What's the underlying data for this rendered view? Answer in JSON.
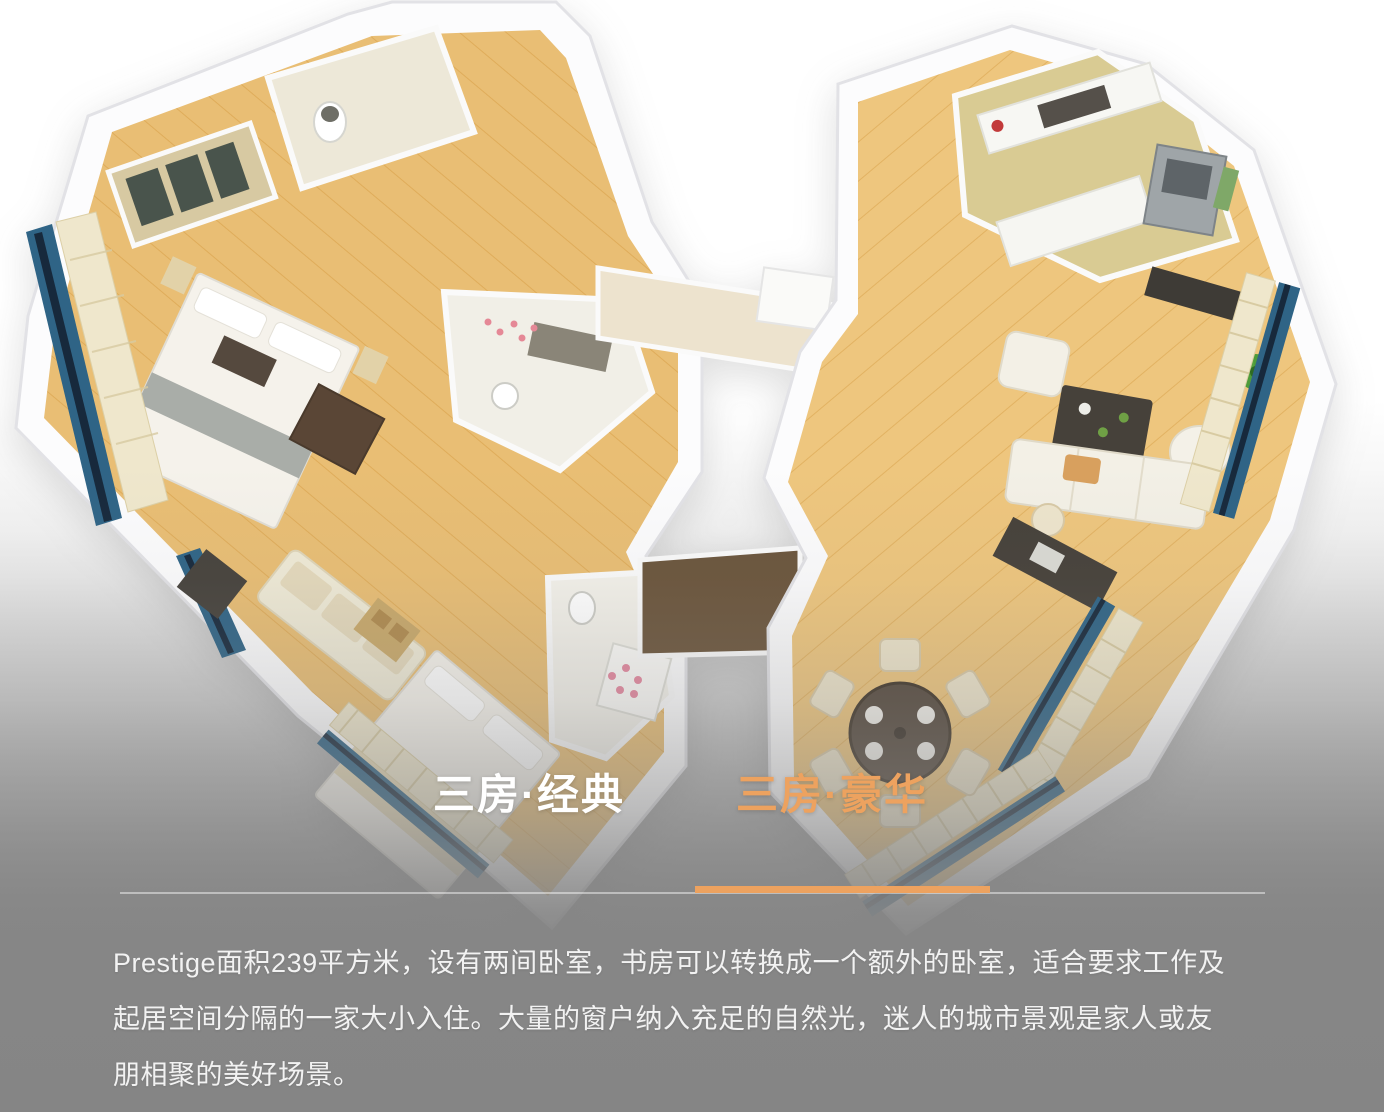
{
  "tabs": {
    "classic": {
      "label": "三房·经典",
      "active": false
    },
    "deluxe": {
      "label": "三房·豪华",
      "active": true
    }
  },
  "description": {
    "lines": [
      "Prestige面积239平方米，设有两间卧室，书房可以转换成一个额外的卧室，适合要求工作及",
      "起居空间分隔的一家大小入住。大量的窗户纳入充足的自然光，迷人的城市景观是家人或友",
      "朋相聚的美好场景。"
    ]
  },
  "colors": {
    "accent_orange": "#eda25f",
    "tab_inactive": "#ffffff",
    "body_text": "#f2f2f2",
    "background_gray": "#868686"
  }
}
